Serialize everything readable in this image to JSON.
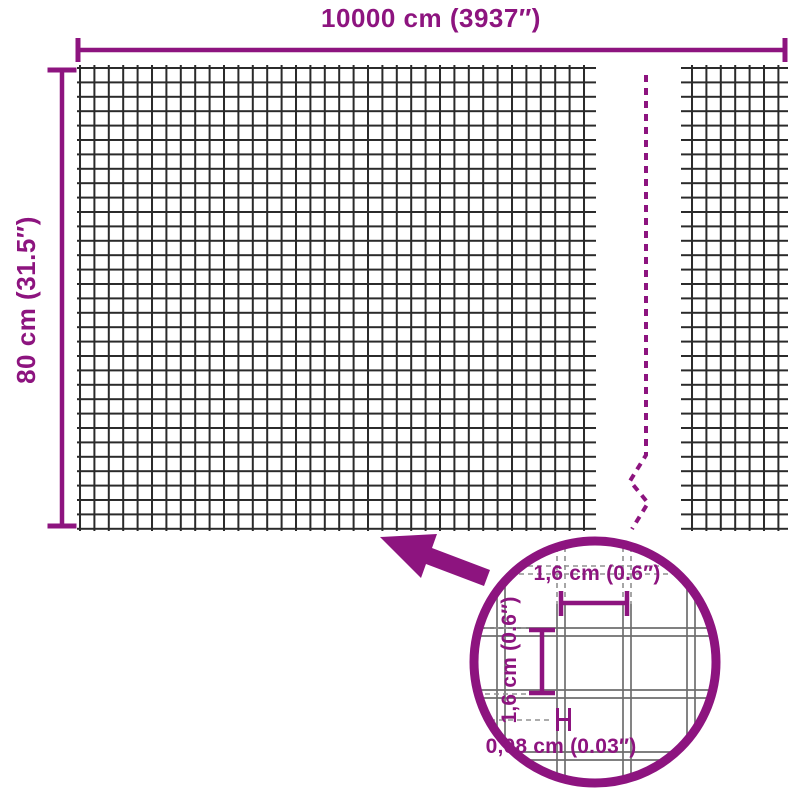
{
  "colors": {
    "accent": "#8D147F",
    "mesh": "#2a2a2a",
    "wire": "#6e6e6e",
    "wire_dash": "#909090",
    "background": "#ffffff"
  },
  "labels": {
    "overall_width": "10000 cm (3937″)",
    "overall_height": "80 cm (31.5″)"
  },
  "detail": {
    "opening_width": "1,6 cm (0.6″)",
    "opening_height": "1,6 cm (0.6″)",
    "wire_thickness": "0,08 cm (0.03″)"
  }
}
